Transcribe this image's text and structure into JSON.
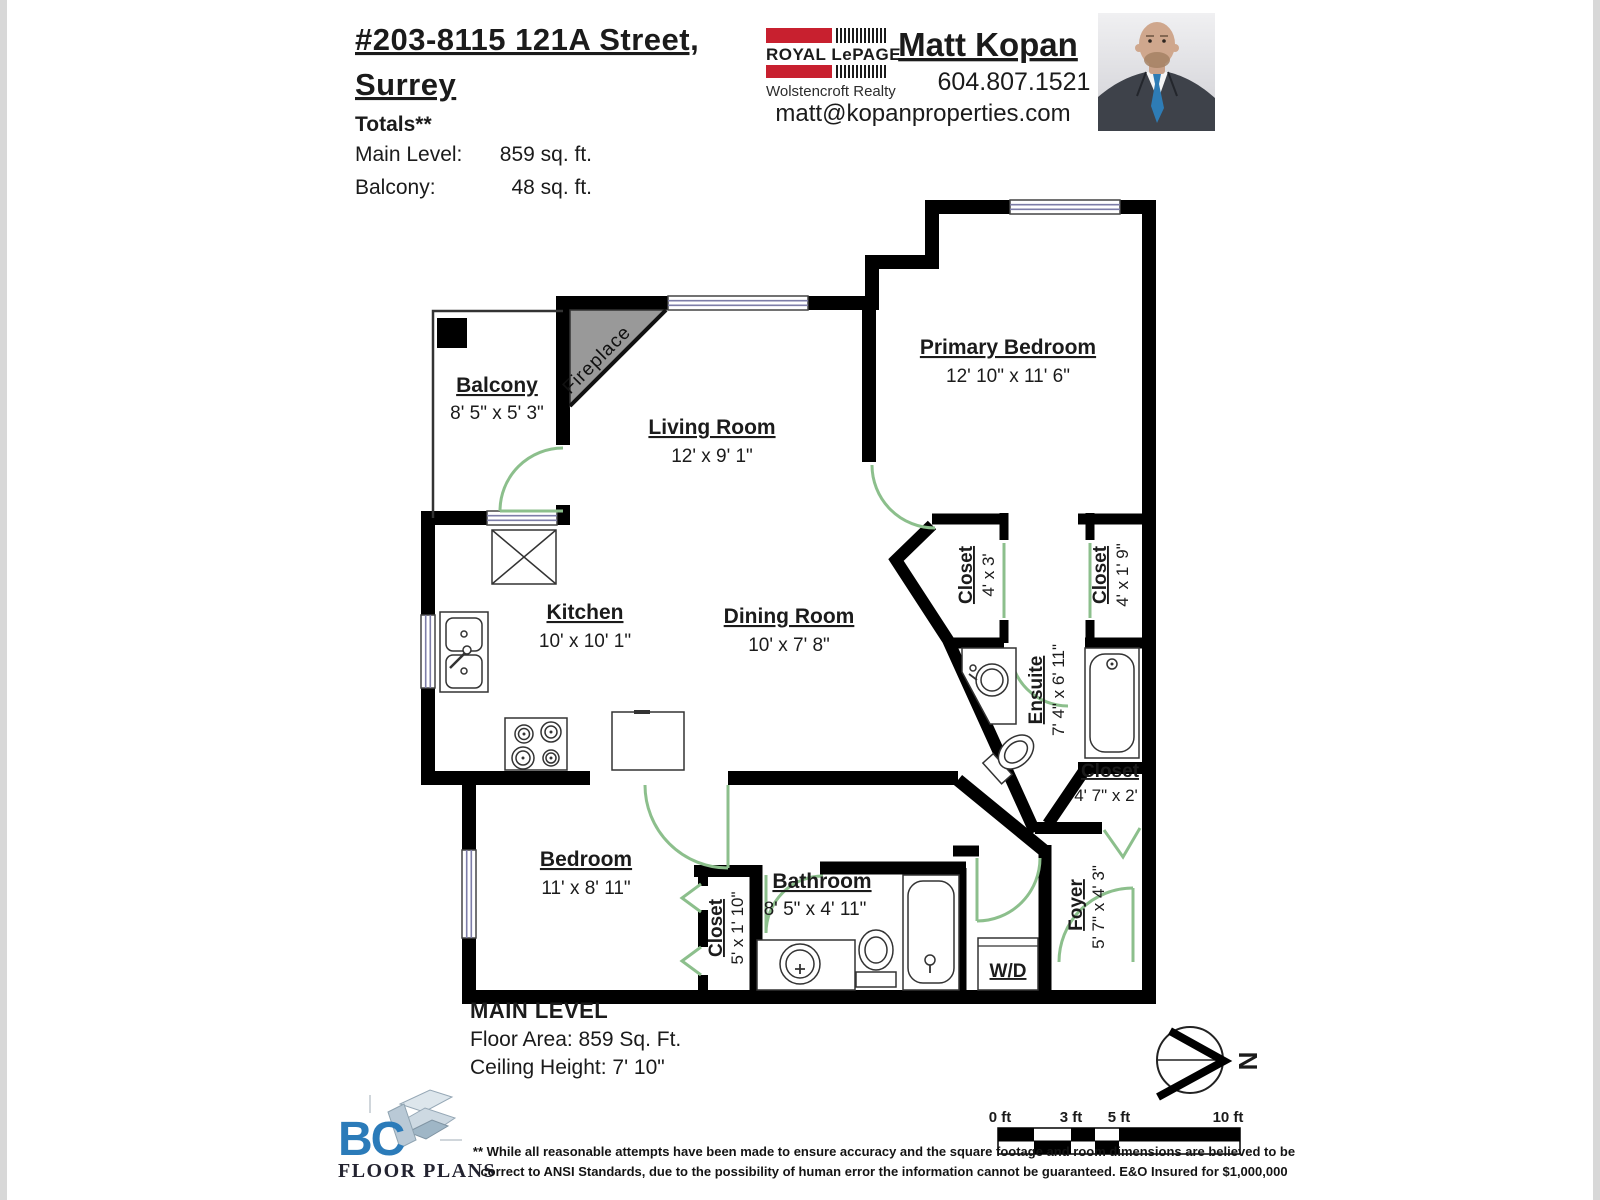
{
  "header": {
    "address_line1": "#203-8115 121A Street,",
    "address_line2": "Surrey",
    "totals_label": "Totals**",
    "totals": [
      {
        "label": "Main Level:",
        "value": "859 sq. ft."
      },
      {
        "label": "Balcony:",
        "value": "48 sq. ft."
      }
    ]
  },
  "agent": {
    "brand_name": "ROYAL LePAGE",
    "brokerage": "Wolstencroft Realty",
    "name": "Matt Kopan",
    "phone": "604.807.1521",
    "email": "matt@kopanproperties.com"
  },
  "plan": {
    "fireplace_label": "Fireplace",
    "wd_label": "W/D",
    "rooms": {
      "balcony": {
        "name": "Balcony",
        "dims": "8' 5\" x 5' 3\""
      },
      "living": {
        "name": "Living Room",
        "dims": "12' x 9' 1\""
      },
      "primary": {
        "name": "Primary Bedroom",
        "dims": "12' 10\" x 11' 6\""
      },
      "kitchen": {
        "name": "Kitchen",
        "dims": "10' x 10' 1\""
      },
      "dining": {
        "name": "Dining Room",
        "dims": "10' x 7' 8\""
      },
      "closet_primary1": {
        "name": "Closet",
        "dims": "4' x 3'"
      },
      "closet_primary2": {
        "name": "Closet",
        "dims": "4' x 1' 9\""
      },
      "ensuite": {
        "name": "Ensuite",
        "dims": "7' 4\" x 6' 11\""
      },
      "closet_hall": {
        "name": "Closet",
        "dims": "4' 7\" x 2'"
      },
      "bedroom": {
        "name": "Bedroom",
        "dims": "11' x 8' 11\""
      },
      "closet_bedroom": {
        "name": "Closet",
        "dims": "5' x 1' 10\""
      },
      "bathroom": {
        "name": "Bathroom",
        "dims": "8' 5\" x 4' 11\""
      },
      "foyer": {
        "name": "Foyer",
        "dims": "5' 7\" x 4' 3\""
      }
    }
  },
  "footer": {
    "level_title": "MAIN LEVEL",
    "floor_area": "Floor Area: 859 Sq. Ft.",
    "ceiling_height": "Ceiling Height: 7' 10\""
  },
  "vendor_logo": {
    "initials": "BC",
    "name": "FLOOR PLANS"
  },
  "scale_bar": {
    "labels": [
      "0 ft",
      "3 ft",
      "5 ft",
      "10 ft"
    ]
  },
  "compass": {
    "north_label": "N"
  },
  "disclaimer": {
    "line1": "** While all reasonable attempts have been made to ensure accuracy and the square footage and room dimensions are believed to be",
    "line2": "correct to ANSI Standards, due to the possibility of human error the information cannot be guaranteed. E&O Insured for $1,000,000"
  },
  "colors": {
    "wall_black": "#000000",
    "door_green": "#8CBF8C",
    "brand_red": "#C8202F",
    "logo_blue": "#2B7BB9",
    "fireplace_gray": "#999999",
    "window_blue": "#7d7da8"
  }
}
